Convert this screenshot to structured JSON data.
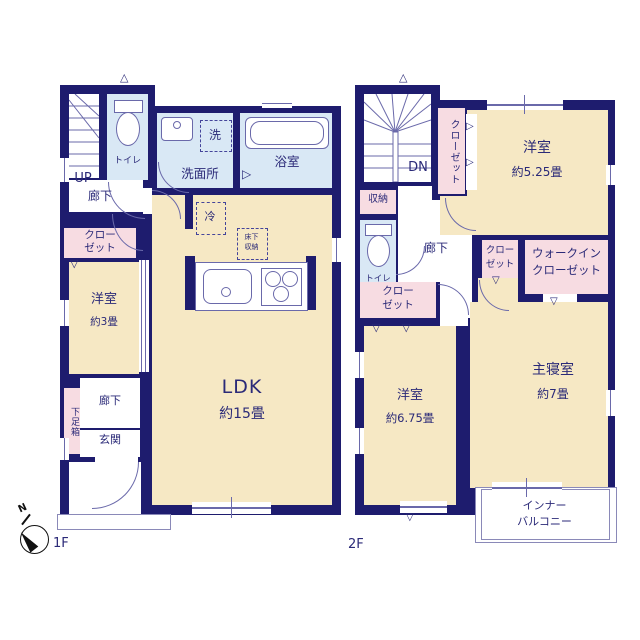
{
  "compass": {
    "label": "N"
  },
  "floor1": {
    "label": "1F",
    "stair_label": "UP",
    "hall_upper": "廊下",
    "toilet": "トイレ",
    "washer": "洗",
    "washroom": "洗面所",
    "bath": "浴室",
    "closet_l1": "クロー",
    "closet_l2": "ゼット",
    "bedroom": {
      "name": "洋室",
      "size": "約3畳"
    },
    "fridge": "冷",
    "underfloor_l1": "床下",
    "underfloor_l2": "収納",
    "ldk": {
      "name": "LDK",
      "size": "約15畳"
    },
    "hall_lower": "廊下",
    "shoe_box": "下足箱",
    "entrance": "玄関"
  },
  "floor2": {
    "label": "2F",
    "stair_label": "DN",
    "storage": "収納",
    "toilet": "トイレ",
    "closet_vertical": "クローゼット",
    "bedroom_a": {
      "name": "洋室",
      "size": "約5.25畳"
    },
    "hall": "廊下",
    "closet_hall_l1": "クロー",
    "closet_hall_l2": "ゼット",
    "closet_small_l1": "クロー",
    "closet_small_l2": "ゼット",
    "wic_l1": "ウォークイン",
    "wic_l2": "クローゼット",
    "bedroom_b": {
      "name": "洋室",
      "size": "約6.75畳"
    },
    "master": {
      "name": "主寝室",
      "size": "約7畳"
    },
    "balcony_l1": "インナー",
    "balcony_l2": "バルコニー"
  },
  "symbols": {
    "down": "▽",
    "up": "△",
    "right": "▷"
  },
  "colors": {
    "wall": "#1e1c6e",
    "room_beige": "#f6e8c4",
    "wet_blue": "#d9e8f5",
    "closet_pink": "#f7dce2",
    "line": "#6a69aa",
    "text": "#2b2a78"
  }
}
